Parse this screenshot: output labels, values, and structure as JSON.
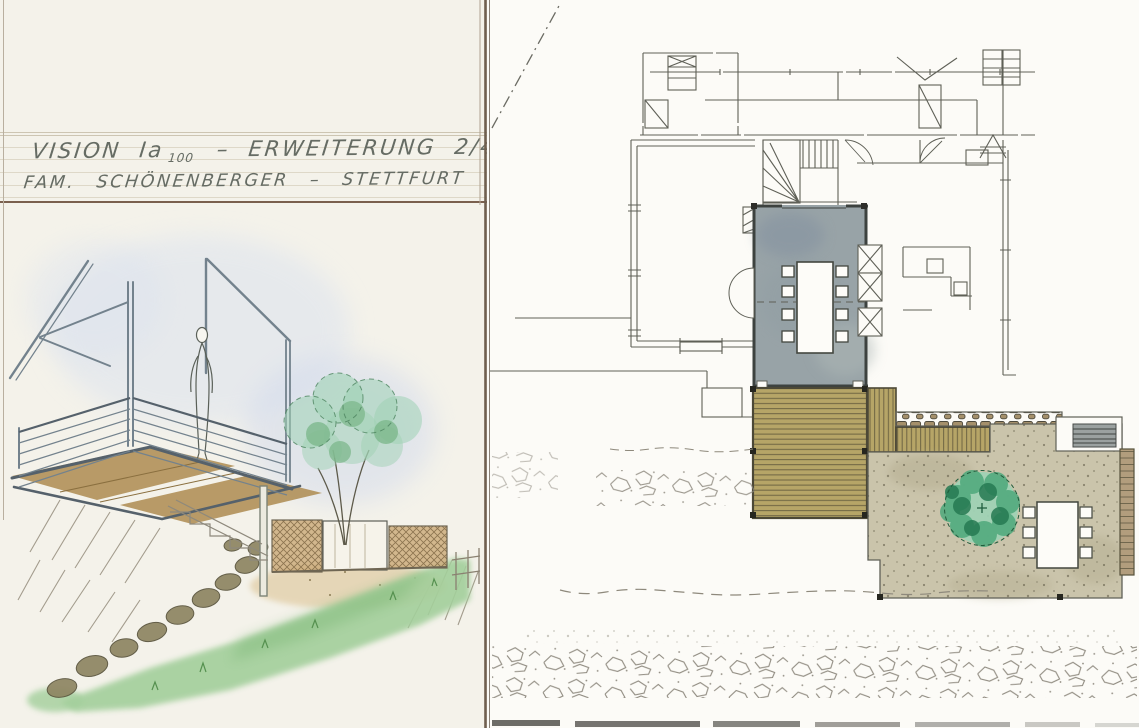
{
  "title_block": {
    "line1_project": "VISION Ia",
    "line1_scale": "100",
    "line1_suffix": "–  ERWEITERUNG  2/4",
    "line2": "FAM. SCHÖNENBERGER  –  STETTFURT"
  },
  "palette": {
    "paper_left": "#f4f2ea",
    "paper_right": "#fcfbf7",
    "pencil": "#5f6057",
    "pencil_light": "#8e897c",
    "steel": "#73828d",
    "steel_dark": "#55616b",
    "wash_blue": "#d9e1ef",
    "deck_wood": "#b6a567",
    "plank_line": "#6e6442",
    "deck_edge": "#4c4836",
    "room_wash": "#98a3a7",
    "room_wall": "#3d423f",
    "terrace": "#cac4ab",
    "terrace_speck": "#5d5844",
    "tree_light": "#9fd2b4",
    "tree_mid": "#4ea87b",
    "tree_dark": "#267a52",
    "tree_line": "#1f5c3c",
    "grass": "#a3cf9b",
    "grass_dark": "#55904f",
    "stone": "#8e8562",
    "stone_line": "#57523b",
    "fence_wood": "#c9a875",
    "hatch_line": "#7a6340",
    "wall_stone": "#b29d7d",
    "grate": "#9ba1a0",
    "cobble": "#a5906b",
    "title_rule": "#7a604e",
    "rule_light": "#cdc5b2",
    "ink": "#666c64",
    "sheet_edge": "#6f5f4f",
    "scan_strip": "#54524d"
  }
}
